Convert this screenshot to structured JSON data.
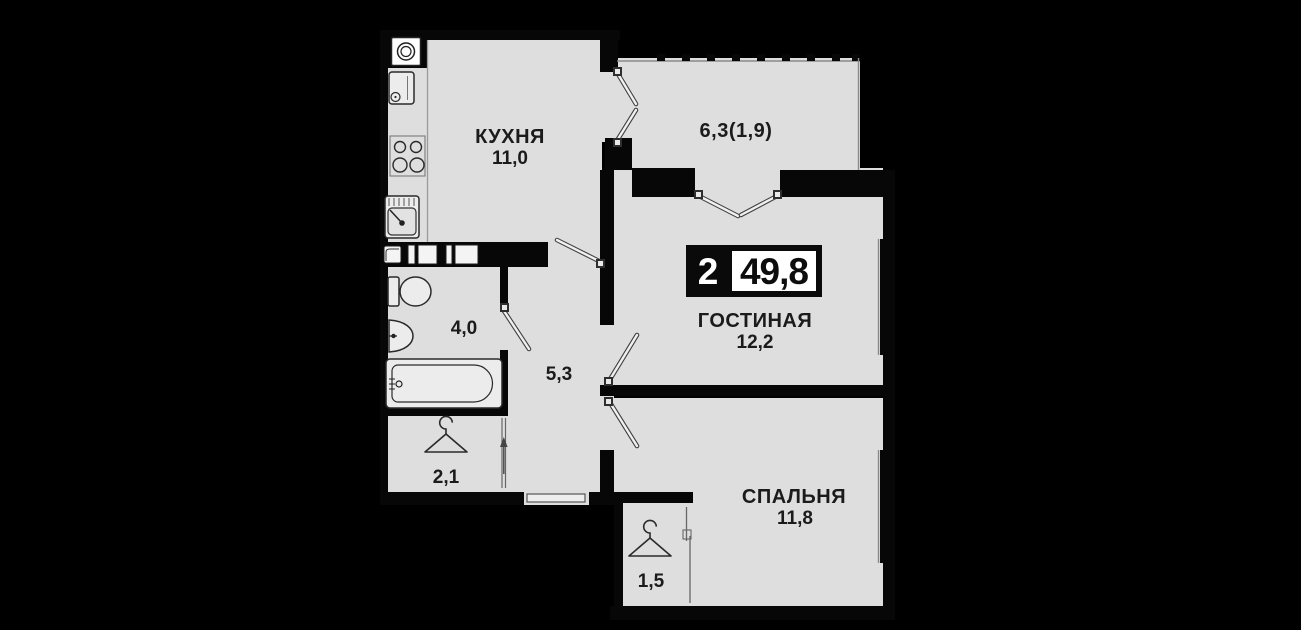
{
  "plan": {
    "badge": {
      "room_count": "2",
      "total_area": "49,8"
    },
    "rooms": {
      "kitchen": {
        "name": "КУХНЯ",
        "area": "11,0"
      },
      "balcony": {
        "area": "6,3(1,9)"
      },
      "living_room": {
        "name": "ГОСТИНАЯ",
        "area": "12,2"
      },
      "bathroom": {
        "area": "4,0"
      },
      "hallway": {
        "area": "5,3"
      },
      "wardrobe": {
        "area": "2,1"
      },
      "bedroom": {
        "name": "СПАЛЬНЯ",
        "area": "11,8"
      },
      "closet": {
        "area": "1,5"
      }
    },
    "icons": {
      "washing_machine": "washing-machine-icon",
      "fridge": "fridge-icon",
      "stove": "stove-burners-icon",
      "kitchen_sink": "kitchen-sink-icon",
      "toilet": "toilet-icon",
      "washbasin": "washbasin-icon",
      "bathtub": "bathtub-icon",
      "wardrobe_hanger": "clothes-hanger-icon",
      "closet_hanger": "clothes-hanger-icon"
    },
    "colors": {
      "background": "#000000",
      "floor": "#dedede",
      "wall": "#070707",
      "text": "#1b1b1b",
      "badge_background": "#0a0a0a",
      "badge_area_background": "#ffffff"
    }
  }
}
